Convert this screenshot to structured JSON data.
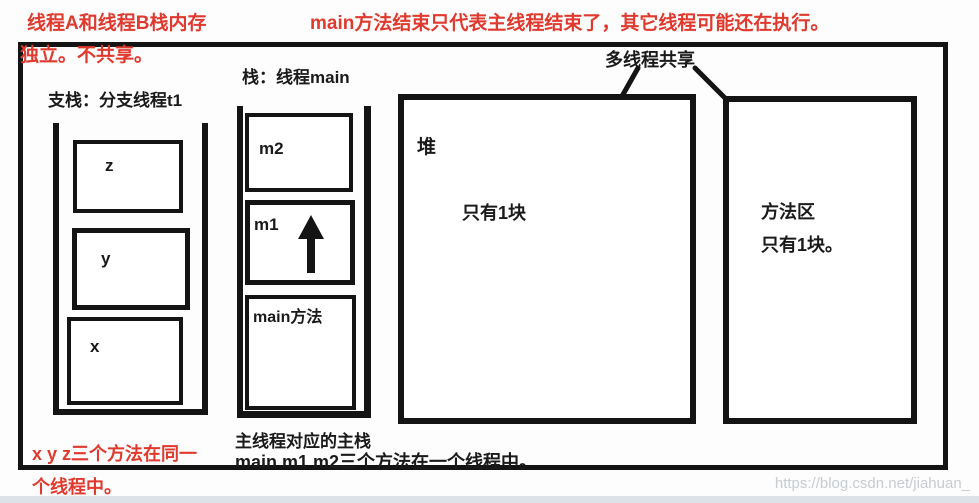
{
  "annotations": {
    "top_left_line1": "线程A和线程B栈内存",
    "top_left_line2": "独立。不共享。",
    "top_center": "main方法结束只代表主线程结束了，其它线程可能还在执行。",
    "bottom_left_line1": "x y z三个方法在同一",
    "bottom_left_line2": "个线程中。"
  },
  "diagram": {
    "branch_stack": {
      "title": "支栈：分支线程t1",
      "frames": [
        "z",
        "y",
        "x"
      ]
    },
    "main_stack": {
      "title": "栈：线程main",
      "frames": [
        "m2",
        "m1",
        "main方法"
      ]
    },
    "shared_label": "多线程共享",
    "heap": {
      "name": "堆",
      "note": "只有1块"
    },
    "method_area": {
      "line1": "方法区",
      "line2": "只有1块。"
    },
    "caption_line1": "主线程对应的主栈",
    "caption_line2": "main m1 m2三个方法在一个线程中。"
  },
  "watermark": "https://blog.csdn.net/jiahuan_",
  "colors": {
    "annotation_red": "#e0392e",
    "ink_black": "#141414",
    "watermark_gray": "#c4c9cf",
    "bottom_strip": "#dde2e8"
  }
}
